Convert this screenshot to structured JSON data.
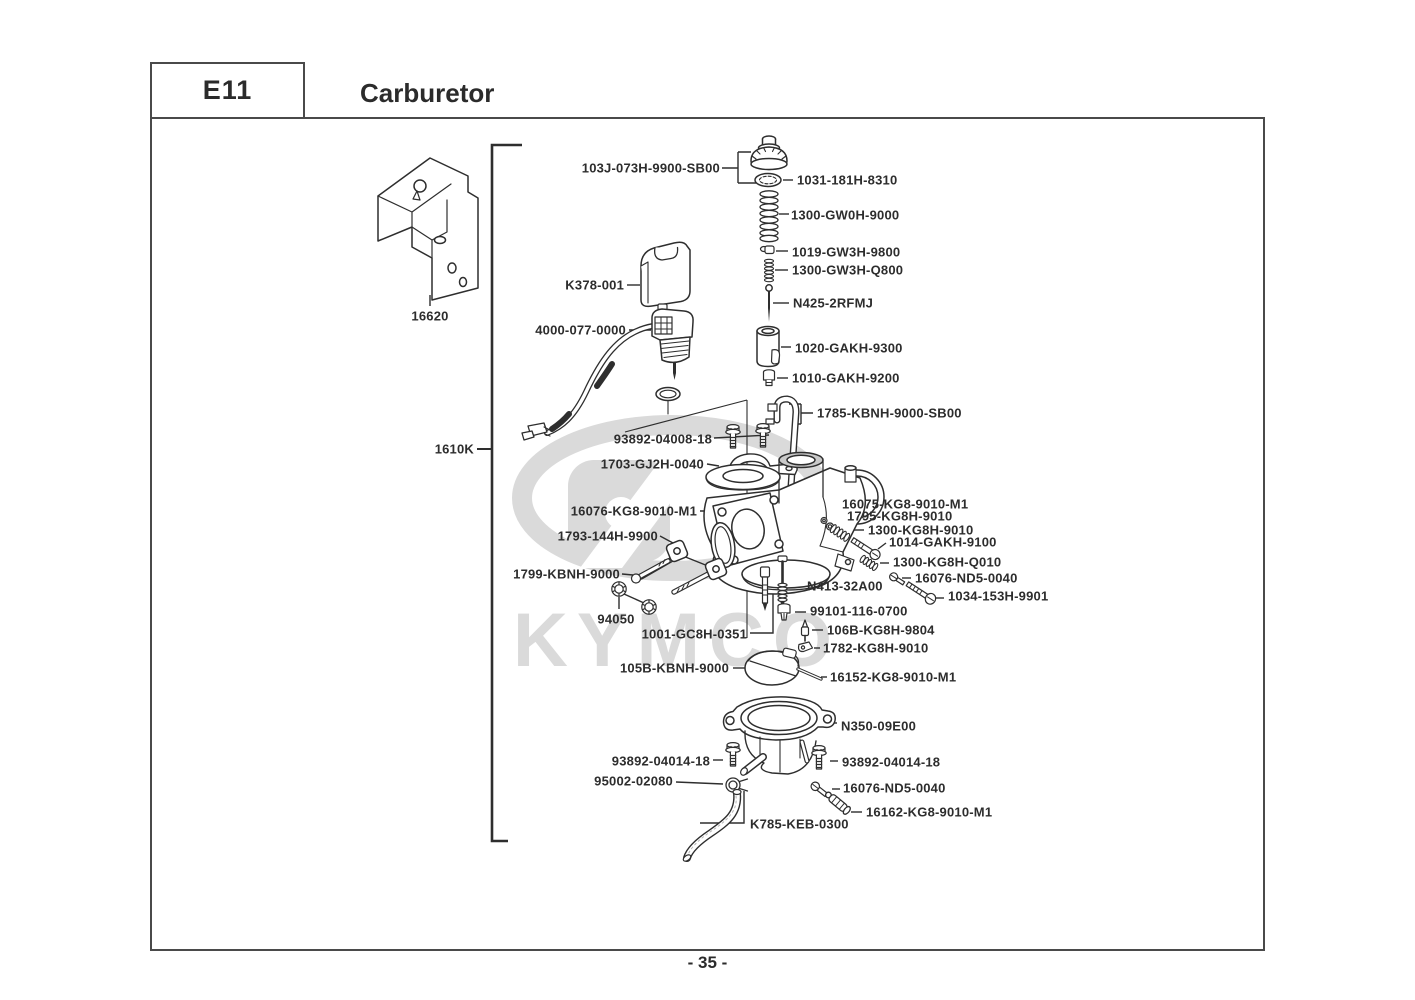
{
  "header": {
    "code": "E11",
    "title": "Carburetor"
  },
  "page_number": "- 35 -",
  "watermark_text": "KYMCO",
  "colors": {
    "line": "#2e2e2e",
    "watermark": "#d9d9d9",
    "border": "#4a4a4a"
  },
  "part_labels": [
    {
      "text": "103J-073H-9900-SB00",
      "x": 720,
      "y": 168,
      "align": "right"
    },
    {
      "text": "1031-181H-8310",
      "x": 797,
      "y": 180,
      "align": "left"
    },
    {
      "text": "1300-GW0H-9000",
      "x": 791,
      "y": 215,
      "align": "left"
    },
    {
      "text": "1019-GW3H-9800",
      "x": 792,
      "y": 252,
      "align": "left"
    },
    {
      "text": "1300-GW3H-Q800",
      "x": 792,
      "y": 270,
      "align": "left"
    },
    {
      "text": "N425-2RFMJ",
      "x": 793,
      "y": 303,
      "align": "left"
    },
    {
      "text": "1020-GAKH-9300",
      "x": 795,
      "y": 348,
      "align": "left"
    },
    {
      "text": "1010-GAKH-9200",
      "x": 792,
      "y": 378,
      "align": "left"
    },
    {
      "text": "K378-001",
      "x": 624,
      "y": 285,
      "align": "right"
    },
    {
      "text": "4000-077-0000",
      "x": 626,
      "y": 330,
      "align": "right"
    },
    {
      "text": "16620",
      "x": 430,
      "y": 316,
      "align": "center"
    },
    {
      "text": "1610K",
      "x": 474,
      "y": 449,
      "align": "right"
    },
    {
      "text": "1785-KBNH-9000-SB00",
      "x": 817,
      "y": 413,
      "align": "left"
    },
    {
      "text": "93892-04008-18",
      "x": 712,
      "y": 439,
      "align": "right"
    },
    {
      "text": "1703-GJ2H-0040",
      "x": 704,
      "y": 464,
      "align": "right"
    },
    {
      "text": "16076-KG8-9010-M1",
      "x": 697,
      "y": 511,
      "align": "right"
    },
    {
      "text": "1793-144H-9900",
      "x": 658,
      "y": 536,
      "align": "right"
    },
    {
      "text": "1799-KBNH-9000",
      "x": 620,
      "y": 574,
      "align": "right"
    },
    {
      "text": "94050",
      "x": 616,
      "y": 619,
      "align": "center"
    },
    {
      "text": "1001-GC8H-0351",
      "x": 747,
      "y": 634,
      "align": "right"
    },
    {
      "text": "16075-KG8-9010-M1",
      "x": 842,
      "y": 504,
      "align": "left"
    },
    {
      "text": "1795-KG8H-9010",
      "x": 847,
      "y": 516,
      "align": "left"
    },
    {
      "text": "1300-KG8H-9010",
      "x": 868,
      "y": 530,
      "align": "left"
    },
    {
      "text": "1014-GAKH-9100",
      "x": 889,
      "y": 542,
      "align": "left"
    },
    {
      "text": "1300-KG8H-Q010",
      "x": 893,
      "y": 562,
      "align": "left"
    },
    {
      "text": "16076-ND5-0040",
      "x": 915,
      "y": 578,
      "align": "left"
    },
    {
      "text": "1034-153H-9901",
      "x": 948,
      "y": 596,
      "align": "left"
    },
    {
      "text": "N413-32A00",
      "x": 807,
      "y": 586,
      "align": "left"
    },
    {
      "text": "99101-116-0700",
      "x": 810,
      "y": 611,
      "align": "left"
    },
    {
      "text": "106B-KG8H-9804",
      "x": 827,
      "y": 630,
      "align": "left"
    },
    {
      "text": "1782-KG8H-9010",
      "x": 823,
      "y": 648,
      "align": "left"
    },
    {
      "text": "105B-KBNH-9000",
      "x": 729,
      "y": 668,
      "align": "right"
    },
    {
      "text": "16152-KG8-9010-M1",
      "x": 830,
      "y": 677,
      "align": "left"
    },
    {
      "text": "N350-09E00",
      "x": 841,
      "y": 726,
      "align": "left"
    },
    {
      "text": "93892-04014-18",
      "x": 710,
      "y": 761,
      "align": "right"
    },
    {
      "text": "93892-04014-18",
      "x": 842,
      "y": 762,
      "align": "left"
    },
    {
      "text": "95002-02080",
      "x": 673,
      "y": 781,
      "align": "right"
    },
    {
      "text": "16076-ND5-0040",
      "x": 843,
      "y": 788,
      "align": "left"
    },
    {
      "text": "16162-KG8-9010-M1",
      "x": 866,
      "y": 812,
      "align": "left"
    },
    {
      "text": "K785-KEB-0300",
      "x": 750,
      "y": 824,
      "align": "left"
    }
  ]
}
